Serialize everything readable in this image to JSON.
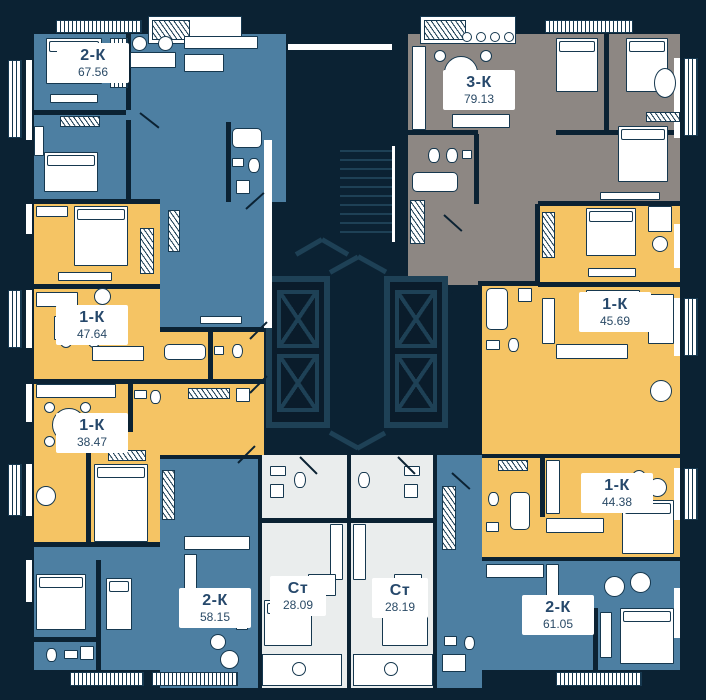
{
  "plan": {
    "name": "residential-floor-plan",
    "apartments": [
      {
        "type": "2-К",
        "area": "67.56",
        "palette": "blue"
      },
      {
        "type": "3-К",
        "area": "79.13",
        "palette": "gray"
      },
      {
        "type": "1-К",
        "area": "47.64",
        "palette": "yellow"
      },
      {
        "type": "1-К",
        "area": "45.69",
        "palette": "yellow"
      },
      {
        "type": "1-К",
        "area": "38.47",
        "palette": "yellow"
      },
      {
        "type": "1-К",
        "area": "44.38",
        "palette": "yellow"
      },
      {
        "type": "2-К",
        "area": "58.15",
        "palette": "blue"
      },
      {
        "type": "Ст",
        "area": "28.09",
        "palette": "light"
      },
      {
        "type": "Ст",
        "area": "28.19",
        "palette": "light"
      },
      {
        "type": "2-К",
        "area": "61.05",
        "palette": "blue"
      }
    ],
    "colors": {
      "wall": "#0b2233",
      "blue": "#4d7fa2",
      "yellow": "#f5c464",
      "gray": "#8d8783",
      "light": "#eaeded",
      "core_lines": "#1e4156",
      "label_text": "#26486b"
    }
  }
}
